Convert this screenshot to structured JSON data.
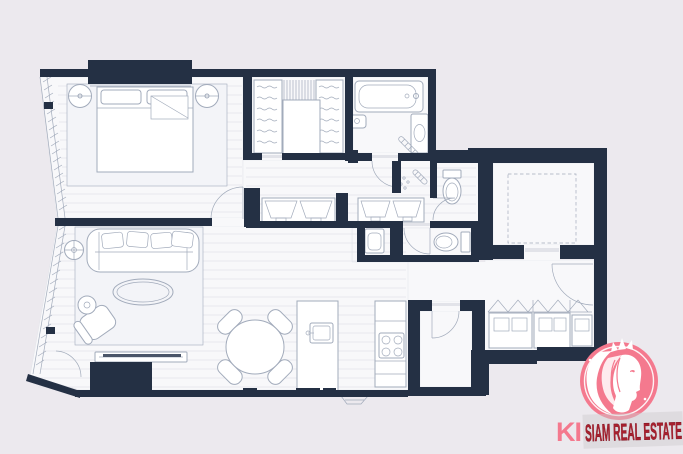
{
  "image": {
    "width": 683,
    "height": 454
  },
  "colors": {
    "background": "#ece9ee",
    "wall": "#243044",
    "floor": "#f8f8fa",
    "floor_line": "#e2e4ea",
    "furniture_stroke": "#a2abbb",
    "furniture_fill": "#ffffff",
    "rug": "#f3f4f8",
    "tv_dark": "#4a5568",
    "watermark_pink": "#f4798e",
    "watermark_red": "#a8212e"
  },
  "watermark": {
    "prefix": "KI",
    "brand": "SIAM REAL ESTATE",
    "logo": "woman-profile-in-pink-circle"
  },
  "floorplan": {
    "type": "floor-plan",
    "rooms": [
      "bedroom",
      "walk-in-closet",
      "bathroom",
      "corridor-dressing-area",
      "wc",
      "second-wc",
      "laundry-nook",
      "hallway",
      "living-room",
      "dining-area",
      "kitchen",
      "store-room",
      "entrance-foyer",
      "lift-shaft"
    ],
    "furniture": [
      "double-bed",
      "bedside-lamps",
      "area-rug",
      "sofa",
      "coffee-table",
      "armchair",
      "side-table",
      "floor-lamp",
      "tv-console",
      "round-dining-table",
      "dining-chairs",
      "kitchen-island-with-sink",
      "cooktop",
      "bathtub",
      "vanity-basin",
      "wash-basin",
      "towel-rail",
      "shower-head",
      "toilets",
      "washing-machine",
      "built-in-wardrobes",
      "shoe-cabinet"
    ]
  }
}
